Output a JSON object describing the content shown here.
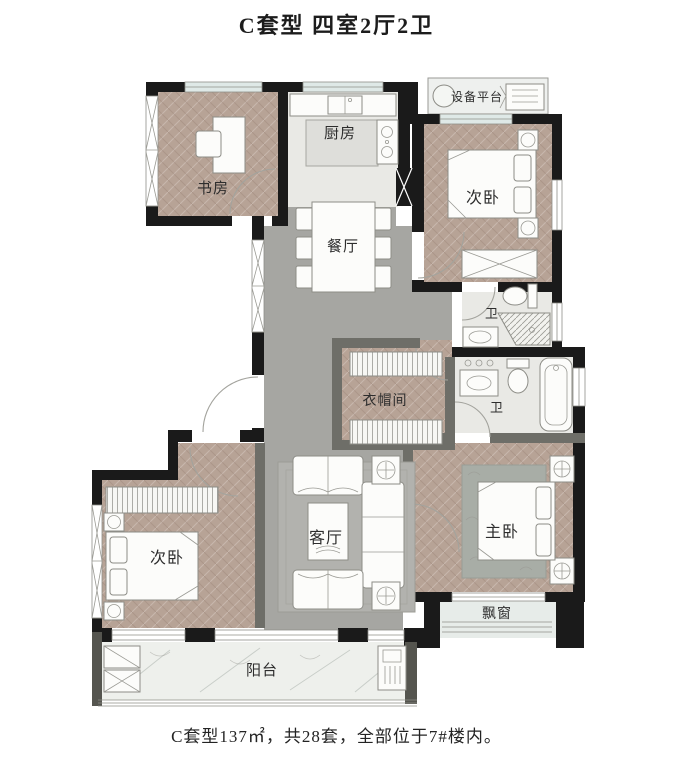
{
  "title": "C套型 四室2厅2卫",
  "caption": "C套型137㎡，共28套，全部位于7#楼内。",
  "rooms": {
    "study": {
      "label": "书房"
    },
    "kitchen": {
      "label": "厨房"
    },
    "equipment_platform": {
      "label": "设备平台"
    },
    "bedroom_ne": {
      "label": "次卧"
    },
    "dining": {
      "label": "餐厅"
    },
    "bath_upper": {
      "label": "卫"
    },
    "bath_lower": {
      "label": "卫"
    },
    "cloakroom": {
      "label": "衣帽间"
    },
    "living": {
      "label": "客厅"
    },
    "bedroom_sw": {
      "label": "次卧"
    },
    "master": {
      "label": "主卧"
    },
    "bay_window": {
      "label": "飘窗"
    },
    "balcony": {
      "label": "阳台"
    }
  },
  "colors": {
    "wall": "#1a1a1a",
    "partition": "#6e6e68",
    "wood_floor": "#b7a396",
    "gray_floor": "#a6a6a2",
    "rug": "#b2b2ae",
    "master_rug": "#a8ada6",
    "tile_floor": "#e9e9e5",
    "balcony_floor": "#eef0ec",
    "window_glass": "#dfe9e7",
    "text": "#2d2d2d"
  }
}
